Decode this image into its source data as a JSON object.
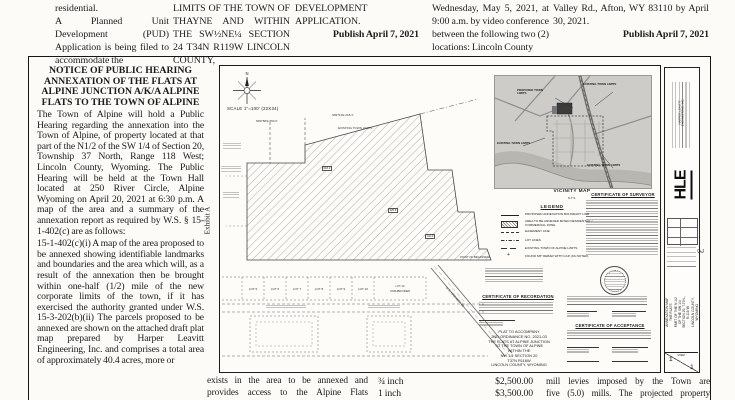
{
  "colors": {
    "paper": "#fcfbf8",
    "ink": "#1b1b1b",
    "map_gray": "#cdccc8",
    "parcel_dark": "#3c3c3c"
  },
  "page_number_sideways": "3",
  "top_columns": {
    "col1": {
      "para1": "residential.",
      "para2": "A Planned Unit Development (PUD) Application is being filed to accommodate the"
    },
    "col2": {
      "para1": "LIMITS OF THE TOWN OF THAYNE AND WITHIN THE SW½NE¼ SECTION 24 T34N R119W LINCOLN COUNTY,"
    },
    "col3": {
      "para1": "DEVELOPMENT APPLICATION.",
      "publish": "Publish April 7, 2021"
    },
    "col4": {
      "para1": "Wednesday, May 5, 2021, at 9:00 a.m. by video conference between the following two (2) locations: Lincoln County"
    },
    "col5": {
      "para1": "Valley Rd., Afton, WY 83110 by April 30, 2021.",
      "publish": "Publish April 7, 2021"
    }
  },
  "notice": {
    "title_line1": "NOTICE OF PUBLIC HEARING",
    "title_line2": "ANNEXATION OF THE FLATS AT",
    "title_line3": "ALPINE JUNCTION A/K/A ALPINE",
    "title_line4": "FLATS TO THE TOWN OF ALPINE",
    "para1": "The Town of Alpine will hold a Public Hearing regarding the annexation into the Town of Alpine, of property located at that part of the N1/2 of the SW 1/4 of Section 20, Township 37 North, Range 118 West; Lincoln County, Wyoming. The Public Hearing will be held at the Town Hall located at 250 River Circle, Alpine Wyoming on April 20, 2021 at 6:30 p.m. A map of the area and a summary of the annexation report as required by W.S. § 15-1-402(c) are as follows:",
    "para2": "15-1-402(c)(i) A map of the area proposed to be annexed showing identifiable landmarks and boundaries and the area which will, as a result of the annexation then be brought within one-half (1/2) mile of the new corporate limits of the town, if it has exercised the authority granted under W.S. 15-3-202(b)(ii) The parcels proposed to be annexed are shown on the attached draft plat map prepared by Harper Leavitt Engineering, Inc. and comprises a total area of approximately 40.4 acres, more or"
  },
  "plat": {
    "exhibit_label": "Exhibit A",
    "north_label": "N",
    "scale_text": "SCALE 1\"=100'  (22X34)",
    "vicinity": {
      "caption": "VICINITY MAP",
      "scale_note": "N.T.S.",
      "label_top": "EXISTING TOWN LIMITS",
      "label_proposed": "PROPOSED TOWN LIMITS",
      "label_left": "EXISTING TOWN LIMITS",
      "label_bottom": "EXISTING TOWN LIMITS"
    },
    "legend": {
      "title": "LEGEND",
      "e1": "PROPOSED ANNEXATION BOUNDARY LINE",
      "e2": "AREA TO BE ANNEXED MIXED RESIDENTIAL / COMMERCIAL ZONE",
      "e3": "EASEMENT LINE",
      "e4": "LOT LINES",
      "e5": "EXISTING TOWN OF ALPINE LIMITS",
      "e6": "FOUND 5/8\" REBAR WITH CAP (AS NOTED)"
    },
    "cert_surveyor_title": "CERTIFICATE OF SURVEYOR",
    "cert_recordation_title": "CERTIFICATE OF RECORDATION",
    "cert_acceptance_title": "CERTIFICATE OF ACCEPTANCE",
    "plat_block": {
      "l1": "PLAT TO ACCOMPANY",
      "l2": "2ND ORDINANCE NO. 2021-03",
      "l3": "THE FLATS AT ALPINE JUNCTION",
      "l4": "TO THE TOWN OF ALPINE",
      "l5": "WITHIN THE",
      "l6": "NW 1/4    SECTION 20",
      "l7": "T37N    R118W",
      "l8": "LINCOLN COUNTY, WYOMING"
    },
    "lots": {
      "lot5": "LOT 5",
      "lot6": "LOT 6",
      "lot7": "LOT 7",
      "lot8": "LOT 8",
      "lot9": "LOT 9",
      "lot10": "LOT 10",
      "lot16_line1": "LOT 16",
      "lot16_line2": "UNSUBDIVIDED"
    },
    "micro": {
      "bearing1": "N89°58'E 660.0'",
      "bearing2": "S89°54'E 218.4'",
      "dim1": "618.2'",
      "dim2": "325.6'",
      "dim3": "142.0'",
      "pob": "POINT OF BEGINNING",
      "highway": "U.S. HIGHWAY 89",
      "existing_limits": "EXISTING TOWN LIMITS"
    },
    "titleblock": {
      "company": "HARPER LEAVITT ENGINEERING, INC.",
      "logo": "HLE",
      "title1": "ANNEXATION MAP THE FLATS",
      "title2": "PART OF THE N 1/2 OF THE SW 1/4",
      "title3": "SECTION 20, T.37N., R.118 W.",
      "title4": "LINCOLN COUNTY, WYOMING",
      "sheet_label": "SHEET",
      "sheet_no": "1",
      "sheet_of": "1"
    }
  },
  "bottom_columns": {
    "col2_line1": "exists in the area to be annexed and",
    "col2_line2": "provides access to the Alpine Flats",
    "fees": {
      "row1_item": "¾ inch",
      "row1_amount": "$2,500.00",
      "row2_item": "1 inch",
      "row2_amount": "$3,500.00"
    },
    "col4_line1": "mill levies imposed by the Town are",
    "col4_line2": "five (5.0) mills. The projected property"
  }
}
